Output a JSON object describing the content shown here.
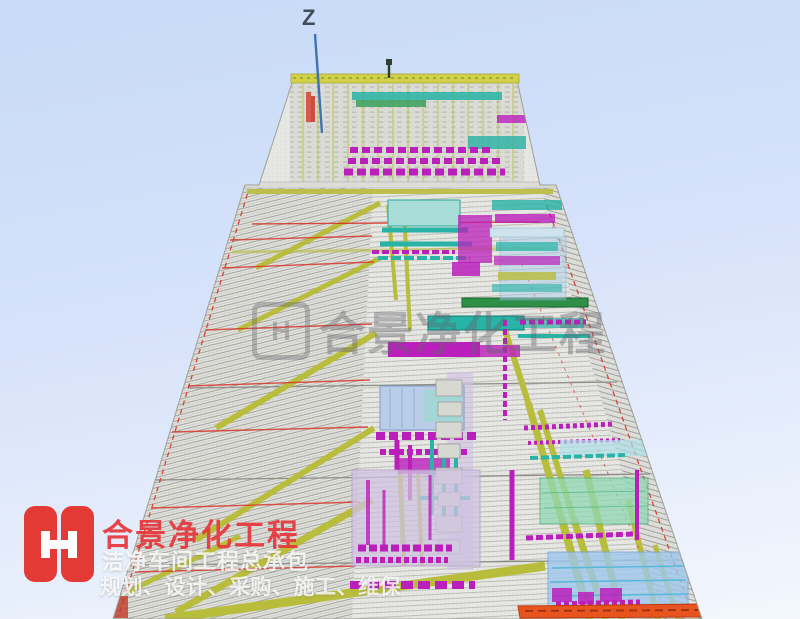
{
  "viewport": {
    "axis_z_label": "Z"
  },
  "watermark": {
    "logo_letter": "H",
    "text": "合景净化工程"
  },
  "branding": {
    "logo_letter": "H",
    "company_name": "合景净化工程",
    "tagline_line1": "洁净车间工程总承包",
    "tagline_line2": "规划、设计、采购、施工、维保"
  },
  "colors": {
    "background_top": "#c7daf7",
    "background_bottom": "#f3f7fd",
    "axis_blue": "#3f72b5",
    "beam_yellow": "#b9bd3c",
    "duct_magenta": "#bb1fbb",
    "pipe_cyan": "#27b3a6",
    "line_red": "#d8372a",
    "panel_blue": "#9ec8ee",
    "panel_lavender": "#cfc3e2",
    "panel_green": "#8fd8b4",
    "wall_gray": "#e3e3df",
    "orange_band": "#e8541e",
    "brand_red": "#e43a36",
    "watermark_gray": "#6e6e74"
  }
}
